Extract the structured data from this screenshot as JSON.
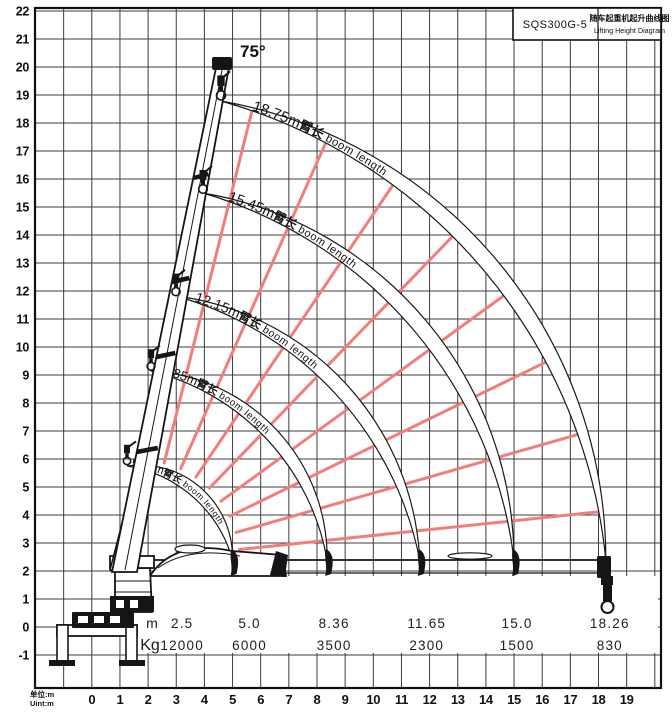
{
  "title_block": {
    "model": "SQS300G-5",
    "title_cn": "随车起重机起升曲线图",
    "title_en": "Lifting Height Diagram"
  },
  "labels": {
    "boom_angle": "75°",
    "unit_cn": "单位:m",
    "unit_en": "Uint:m"
  },
  "chart_data": {
    "type": "line",
    "title": "SQS300G-5 随车起重机起升曲线图 Lifting Height Diagram",
    "xlabel": "单位:m (Uint:m)",
    "ylabel": "单位:m (Uint:m)",
    "x_ticks": [
      0,
      1,
      2,
      3,
      4,
      5,
      6,
      7,
      8,
      9,
      10,
      11,
      12,
      13,
      14,
      15,
      16,
      17,
      18,
      19
    ],
    "y_ticks": [
      -1,
      0,
      1,
      2,
      3,
      4,
      5,
      6,
      7,
      8,
      9,
      10,
      11,
      12,
      13,
      14,
      15,
      16,
      17,
      18,
      19,
      20,
      21,
      22
    ],
    "x_range": [
      -2,
      20.2
    ],
    "y_range": [
      -2.2,
      22.1
    ],
    "grid": true,
    "boom_angle_max_deg": 75,
    "boom_lengths_m": [
      5.52,
      8.85,
      12.15,
      15.45,
      18.75
    ],
    "arc_labels": [
      {
        "len": "5.52m",
        "cn": "臂长",
        "en": " boom length"
      },
      {
        "len": "8.85m",
        "cn": "臂长",
        "en": " boom length"
      },
      {
        "len": "12.15m",
        "cn": "臂长",
        "en": " boom length"
      },
      {
        "len": "15.45m",
        "cn": "臂长",
        "en": " boom length"
      },
      {
        "len": "18.75m",
        "cn": "臂长",
        "en": " boom length"
      }
    ],
    "load_table": {
      "rows": [
        "m",
        "Kg"
      ],
      "outreach_m": [
        "2.5",
        "5.0",
        "8.36",
        "11.65",
        "15.0",
        "18.26"
      ],
      "capacity_kg": [
        "12000",
        "6000",
        "3500",
        "2300",
        "1500",
        "830"
      ]
    },
    "colors": {
      "curve": "#1a1a1a",
      "radial_lines": "#f27d7d",
      "grid": "#3c3c3c",
      "frame": "#111111"
    }
  }
}
